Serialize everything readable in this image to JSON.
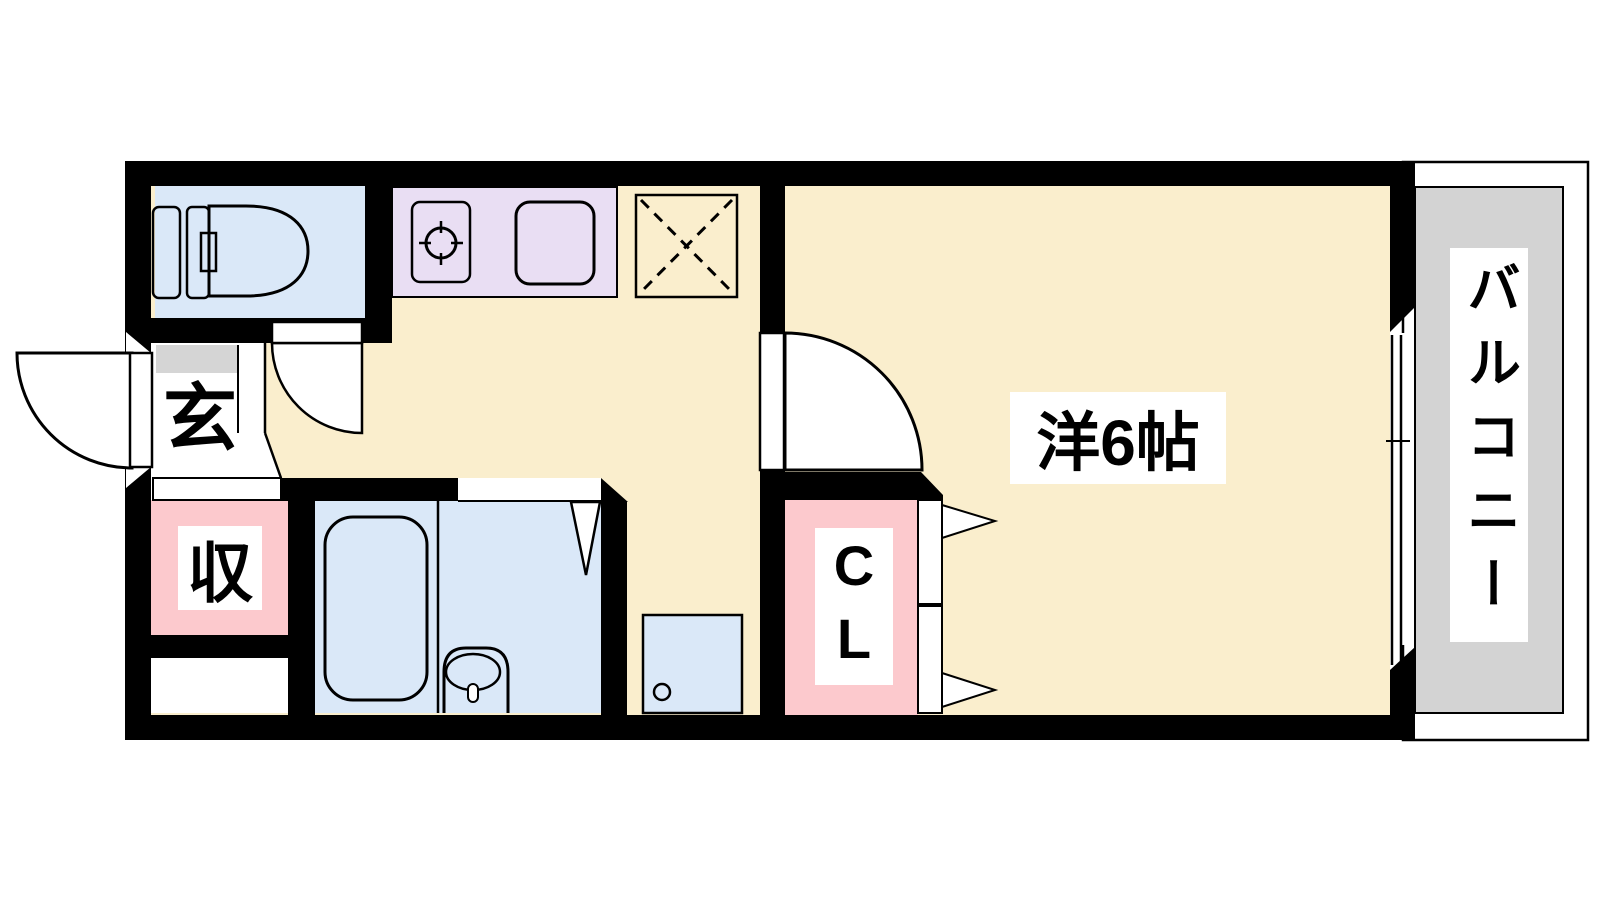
{
  "floorplan": {
    "labels": {
      "entrance": "玄",
      "storage": "収",
      "closet": "CL",
      "western_room": "洋6帖",
      "balcony": "バルコニー"
    },
    "colors": {
      "floor": "#FAEECD",
      "water_rooms": "#DAE8F8",
      "kitchen_counter": "#E9DEF3",
      "storage_pink": "#FCC9CD",
      "balcony_gray": "#D3D3D3",
      "entrance_gray": "#D5D5D5",
      "wall": "#000000",
      "line": "#000000",
      "background": "#FFFFFF"
    }
  }
}
